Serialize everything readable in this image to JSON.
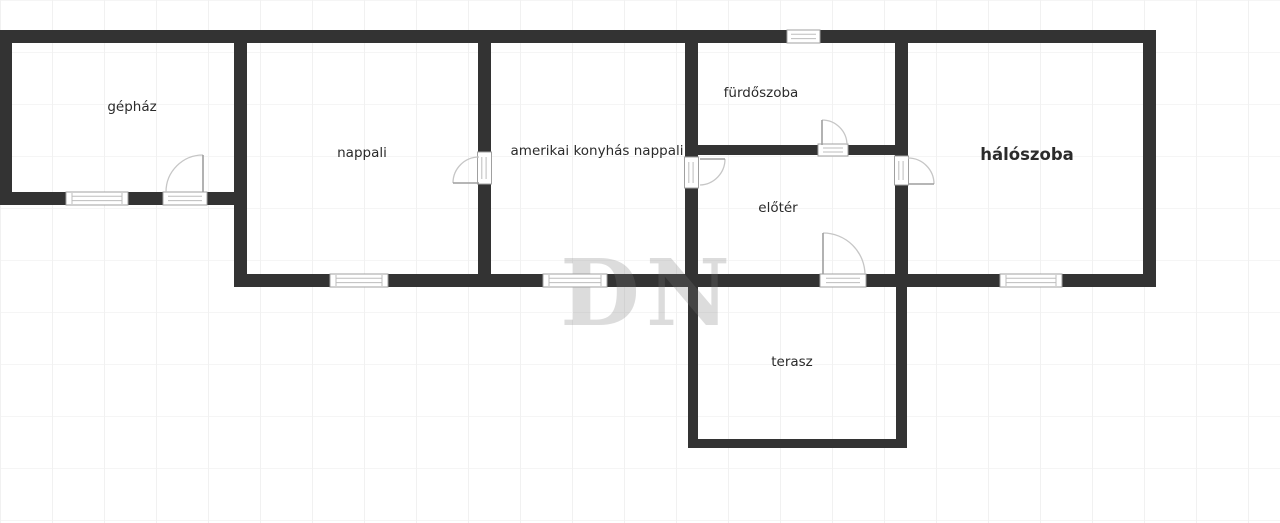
{
  "colors": {
    "background": "#ffffff",
    "grid_line": "#f1f1f1",
    "wall": "#333333",
    "label_text": "#2b2b2b",
    "door_arc": "#c6c6c6",
    "door_leaf": "#9e9e9e",
    "window_border": "#a0a0a0",
    "watermark": "#777777"
  },
  "floor_plan": {
    "rooms": [
      {
        "label": "gépház"
      },
      {
        "label": "nappali"
      },
      {
        "label": "amerikai konyhás nappali"
      },
      {
        "label": "fürdőszoba"
      },
      {
        "label": "előtér"
      },
      {
        "label": "hálószoba"
      },
      {
        "label": "terasz"
      }
    ],
    "watermark": "DN"
  }
}
